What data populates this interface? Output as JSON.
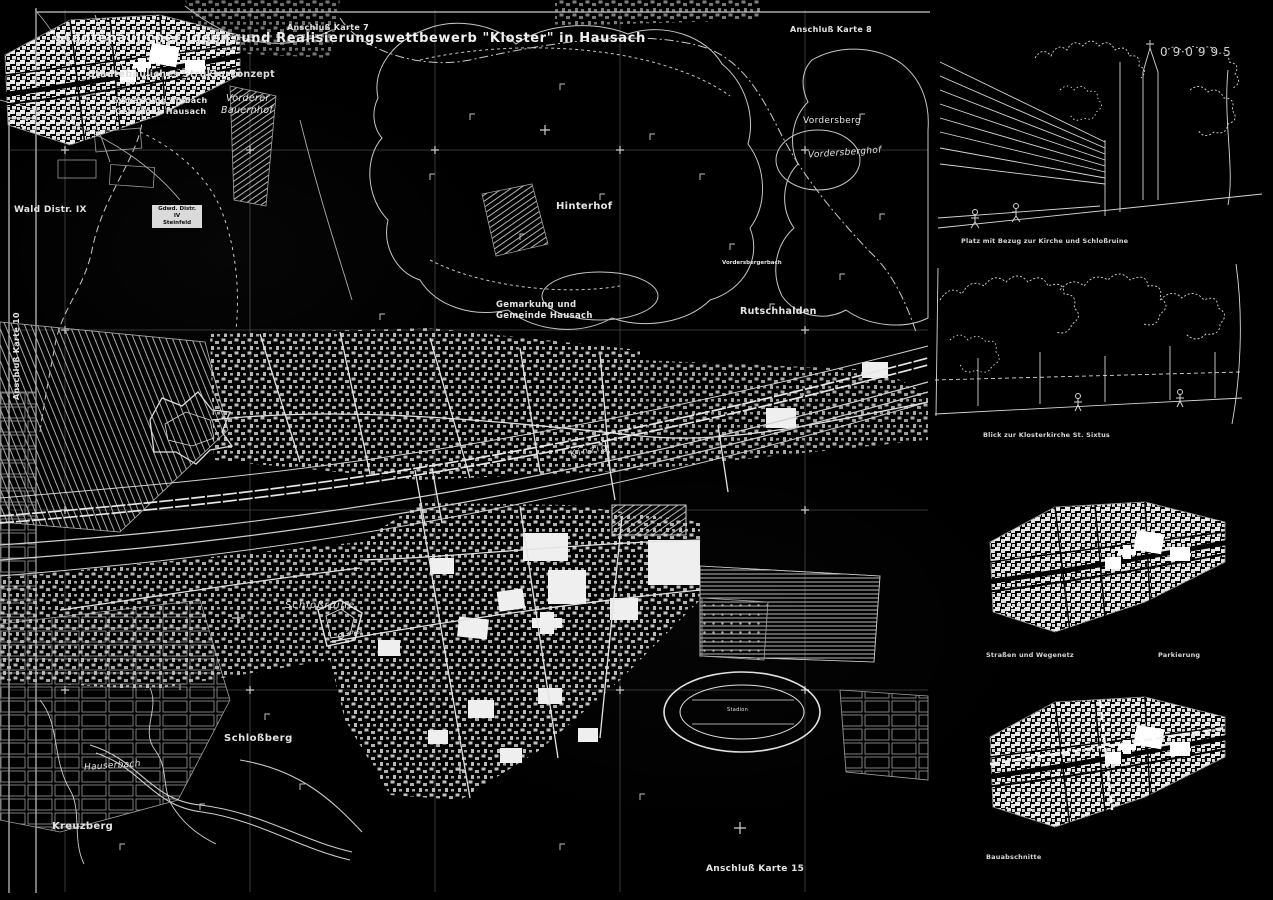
{
  "title": {
    "main": "Städtebaulicher Ideen- und Realisierungswettbewerb \"Kloster\" in Hausach",
    "subtitle": "Städtebauliches Strukturkonzept"
  },
  "sheet_number": "090995",
  "edge_labels": {
    "top_left": "Anschluß Karte 7",
    "top_right": "Anschluß Karte 8",
    "left": "Anschluß Karte 10",
    "bottom": "Anschluß Karte 15"
  },
  "map_labels": {
    "wald_distr": "Wald Distr. IX",
    "gdwd_line1": "Gdwd. Distr. IV",
    "gdwd_line2": "Steinfeld",
    "gemarkung_einbach_line1": "Gemarkung Einbach",
    "gemarkung_einbach_line2": "Gemeinde Hausach",
    "vorderer_line1": "Vorderer",
    "vorderer_line2": "Bauernhof",
    "hinterhof": "Hinterhof",
    "vordersberg": "Vordersberg",
    "vordersberghof": "Vordersberghof",
    "vordersbergerbach": "Vordersbergerbach",
    "gemarkung_hausach_line1": "Gemarkung und",
    "gemarkung_hausach_line2": "Gemeinde Hausach",
    "rutschhalden": "Rutschhalden",
    "kinzig": "Kinzig",
    "schlossruine": "Schloßruine",
    "schloss": "Schloß",
    "schlossberg": "Schloßberg",
    "hauserbach": "Hauserbach",
    "kreuzberg": "Kreuzberg",
    "stadion": "Stadion"
  },
  "insets": {
    "sketch_church_square_caption": "Platz mit Bezug zur Kirche und Schloßruine",
    "sketch_monastery_caption": "Blick zur Klosterkirche St. Sixtus",
    "network_map_caption": "Straßen und Wegenetz",
    "parking_caption": "Parkierung",
    "phases_map_caption": "Bauabschnitte"
  },
  "colors": {
    "background": "#000000",
    "linework": "#dcdcdc",
    "grid": "#474747"
  }
}
